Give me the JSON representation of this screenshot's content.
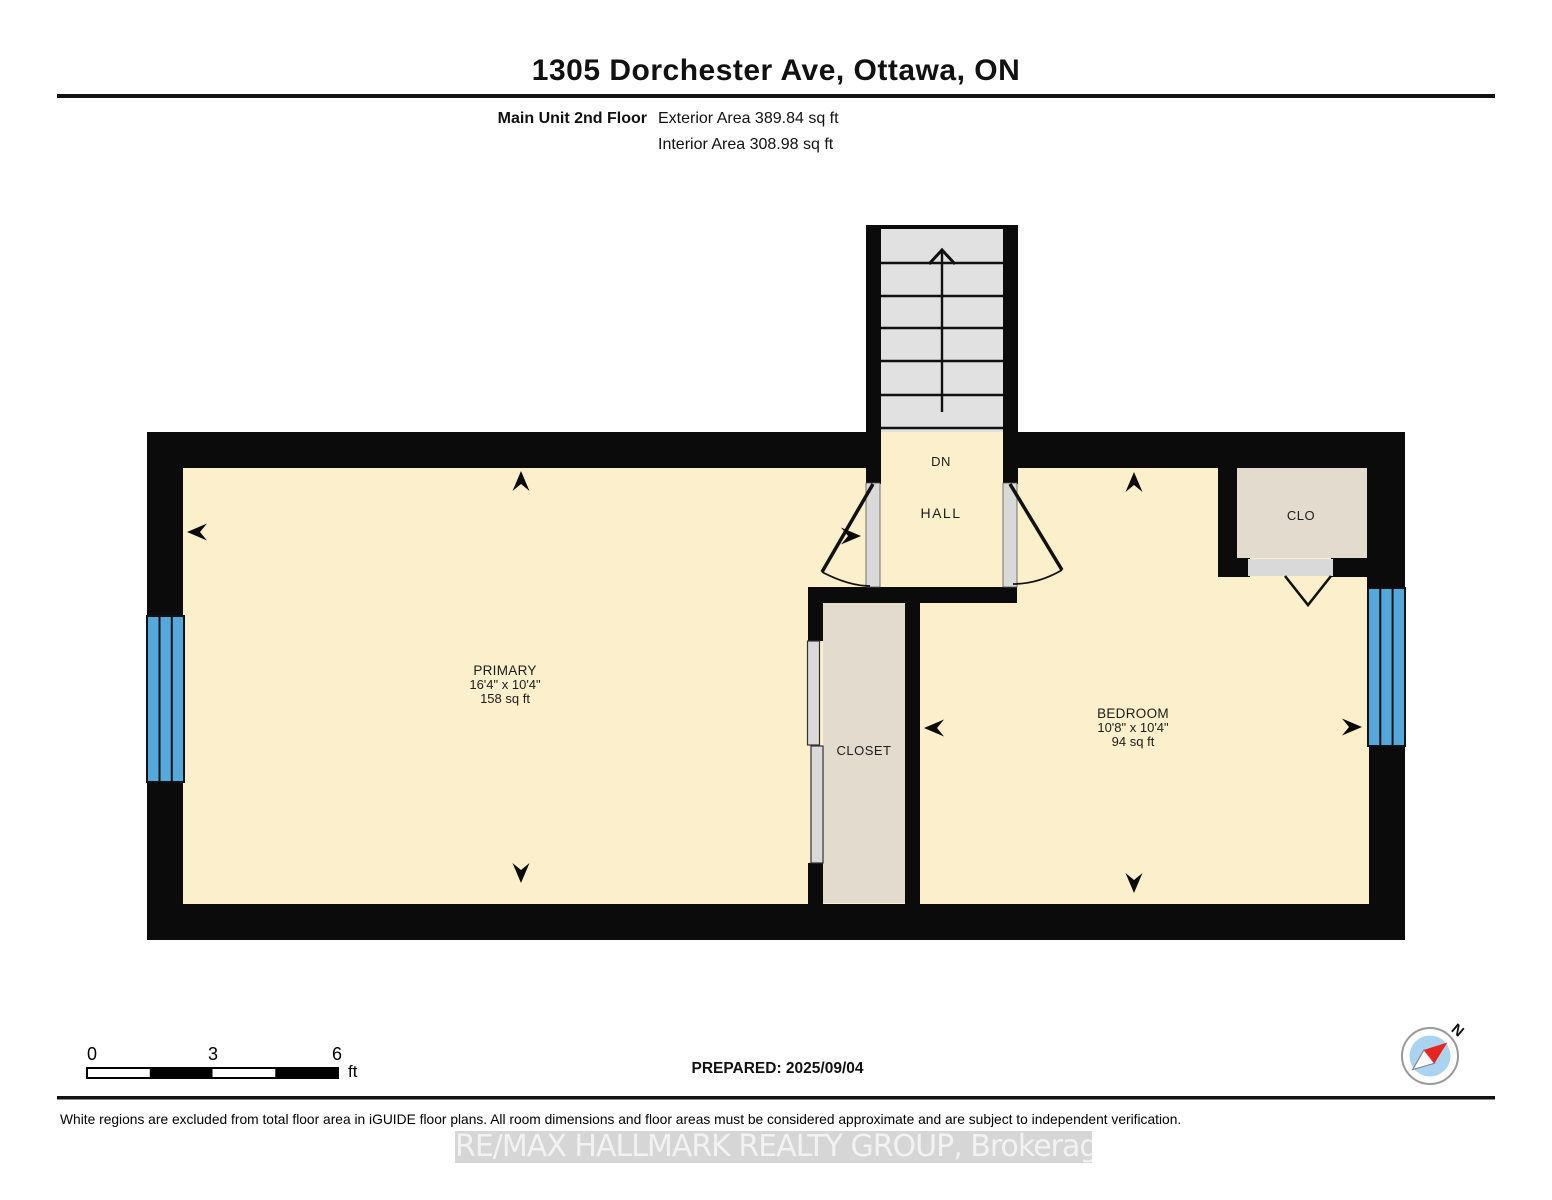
{
  "header": {
    "title": "1305 Dorchester Ave, Ottawa, ON",
    "floor_label": "Main Unit 2nd Floor",
    "exterior_area": "Exterior Area 389.84 sq ft",
    "interior_area": "Interior Area 308.98 sq ft"
  },
  "rooms": {
    "primary": {
      "name": "PRIMARY",
      "dimensions": "16'4\" x 10'4\"",
      "area": "158 sq ft"
    },
    "bedroom": {
      "name": "BEDROOM",
      "dimensions": "10'8\" x 10'4\"",
      "area": "94 sq ft"
    },
    "closet": {
      "name": "CLOSET"
    },
    "clo": {
      "name": "CLO"
    },
    "hall": {
      "name": "HALL",
      "stair_label": "DN"
    }
  },
  "scale_bar": {
    "start": "0",
    "mid": "3",
    "end": "6",
    "unit": "ft"
  },
  "compass": {
    "north_label": "N"
  },
  "footer": {
    "prepared": "PREPARED: 2025/09/04",
    "disclaimer": "White regions are excluded from total floor area in iGUIDE floor plans. All room dimensions and floor areas must be considered approximate and are subject to independent verification.",
    "watermark": "RE/MAX HALLMARK REALTY GROUP, Brokerage"
  },
  "colors": {
    "floor": "#FBF0CB",
    "closet_floor": "#E2DBCE",
    "stair_tread": "#E1E1E1",
    "window_blue": "#54A8DB",
    "wall": "#0B0B0B",
    "door_jamb": "#D9D9D9",
    "compass_inner": "#A9D3EE",
    "compass_needle": "#E8251F"
  }
}
